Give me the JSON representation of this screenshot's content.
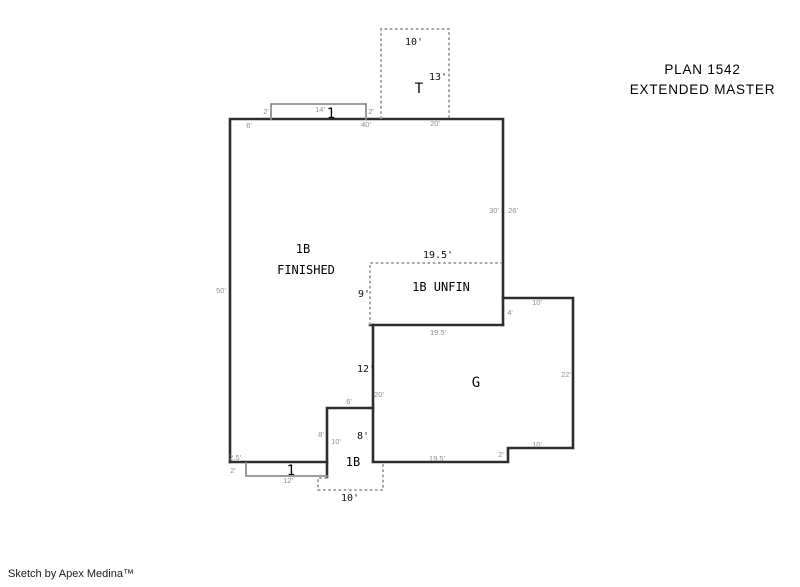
{
  "title": {
    "line1": "PLAN 1542",
    "line2": "EXTENDED MASTER"
  },
  "footer": {
    "credit": "Sketch by Apex Medina™"
  },
  "colors": {
    "background": "#ffffff",
    "wall": "#2e2e2e",
    "porch_outline": "#8f8f8f",
    "dashed_outline": "#9a9a9a",
    "dim_label_black": "#111111",
    "dim_label_gray": "#8e8e8e",
    "text": "#000000"
  },
  "plan": {
    "labels": [
      {
        "name": "tuck-under-width-dim",
        "text": "10'",
        "x": 414,
        "y": 45,
        "cls": "dim"
      },
      {
        "name": "tuck-under-height-dim",
        "text": "13'",
        "x": 438,
        "y": 80,
        "cls": "dim"
      },
      {
        "name": "tuck-under-room-label",
        "text": "T",
        "x": 419,
        "y": 93,
        "cls": "big"
      },
      {
        "name": "front-porch-left-dim",
        "text": "2'",
        "x": 266,
        "y": 114,
        "cls": "dim-g"
      },
      {
        "name": "front-porch-width-dim",
        "text": "14'",
        "x": 320,
        "y": 112,
        "cls": "dim-g"
      },
      {
        "name": "front-door-marker",
        "text": "1",
        "x": 331,
        "y": 118,
        "cls": "marker"
      },
      {
        "name": "front-porch-right-dim",
        "text": "2'",
        "x": 371,
        "y": 114,
        "cls": "dim-g"
      },
      {
        "name": "top-wall-left-dim",
        "text": "6'",
        "x": 249,
        "y": 128,
        "cls": "dim-g"
      },
      {
        "name": "top-wall-mid-dim",
        "text": "40'",
        "x": 366,
        "y": 127,
        "cls": "dim-g"
      },
      {
        "name": "top-wall-right-dim",
        "text": "20'",
        "x": 435,
        "y": 126,
        "cls": "dim-g"
      },
      {
        "name": "right-wall-inner-dim",
        "text": "30'",
        "x": 494,
        "y": 213,
        "cls": "dim-g"
      },
      {
        "name": "right-wall-outer-dim",
        "text": "26'",
        "x": 513,
        "y": 213,
        "cls": "dim-g"
      },
      {
        "name": "left-wall-dim",
        "text": "50'",
        "x": 221,
        "y": 293,
        "cls": "dim-g"
      },
      {
        "name": "main-room-label",
        "text": "1B",
        "x": 303,
        "y": 253,
        "cls": "room"
      },
      {
        "name": "main-room-sublabel",
        "text": "FINISHED",
        "x": 306,
        "y": 274,
        "cls": "room"
      },
      {
        "name": "unfin-width-dim",
        "text": "19.5'",
        "x": 438,
        "y": 258,
        "cls": "dim"
      },
      {
        "name": "unfin-height-dim",
        "text": "9'",
        "x": 364,
        "y": 297,
        "cls": "dim"
      },
      {
        "name": "unfin-room-label",
        "text": "1B UNFIN",
        "x": 441,
        "y": 291,
        "cls": "room"
      },
      {
        "name": "unfin-bottom-dim",
        "text": "19.5'",
        "x": 438,
        "y": 335,
        "cls": "dim-g"
      },
      {
        "name": "garage-step-dim",
        "text": "4'",
        "x": 510,
        "y": 315,
        "cls": "dim-g"
      },
      {
        "name": "garage-top-dim",
        "text": "10'",
        "x": 537,
        "y": 305,
        "cls": "dim-g"
      },
      {
        "name": "garage-room-label",
        "text": "G",
        "x": 476,
        "y": 387,
        "cls": "big"
      },
      {
        "name": "garage-right-dim",
        "text": "22'",
        "x": 566,
        "y": 377,
        "cls": "dim-g"
      },
      {
        "name": "garage-left-upper-dim",
        "text": "12'",
        "x": 366,
        "y": 372,
        "cls": "dim"
      },
      {
        "name": "garage-left-dim",
        "text": "20'",
        "x": 379,
        "y": 397,
        "cls": "dim-g"
      },
      {
        "name": "bay-jog-dim",
        "text": "6'",
        "x": 349,
        "y": 404,
        "cls": "dim-g"
      },
      {
        "name": "bay-left-outer-dim",
        "text": "8'",
        "x": 321,
        "y": 437,
        "cls": "dim-g"
      },
      {
        "name": "bay-left-inner-dim",
        "text": "10'",
        "x": 336,
        "y": 444,
        "cls": "dim-g"
      },
      {
        "name": "bay-right-dim",
        "text": "8'",
        "x": 363,
        "y": 439,
        "cls": "dim"
      },
      {
        "name": "bay-room-label",
        "text": "1B",
        "x": 353,
        "y": 466,
        "cls": "room"
      },
      {
        "name": "garage-bottom-right-dim",
        "text": "10'",
        "x": 537,
        "y": 447,
        "cls": "dim-g"
      },
      {
        "name": "garage-step-down-dim",
        "text": "2'",
        "x": 501,
        "y": 457,
        "cls": "dim-g"
      },
      {
        "name": "garage-bottom-dim",
        "text": "19.5'",
        "x": 437,
        "y": 461,
        "cls": "dim-g"
      },
      {
        "name": "rear-wall-inset-dim",
        "text": "2.5'",
        "x": 235,
        "y": 460,
        "cls": "dim-g"
      },
      {
        "name": "rear-porch-depth-dim",
        "text": "2'",
        "x": 233,
        "y": 473,
        "cls": "dim-g"
      },
      {
        "name": "rear-door-marker",
        "text": "1",
        "x": 291,
        "y": 475,
        "cls": "marker"
      },
      {
        "name": "rear-porch-width-dim",
        "text": "12'",
        "x": 288,
        "y": 483,
        "cls": "dim-g"
      },
      {
        "name": "rear-patio-width-dim",
        "text": "10'",
        "x": 350,
        "y": 501,
        "cls": "dim"
      }
    ]
  }
}
